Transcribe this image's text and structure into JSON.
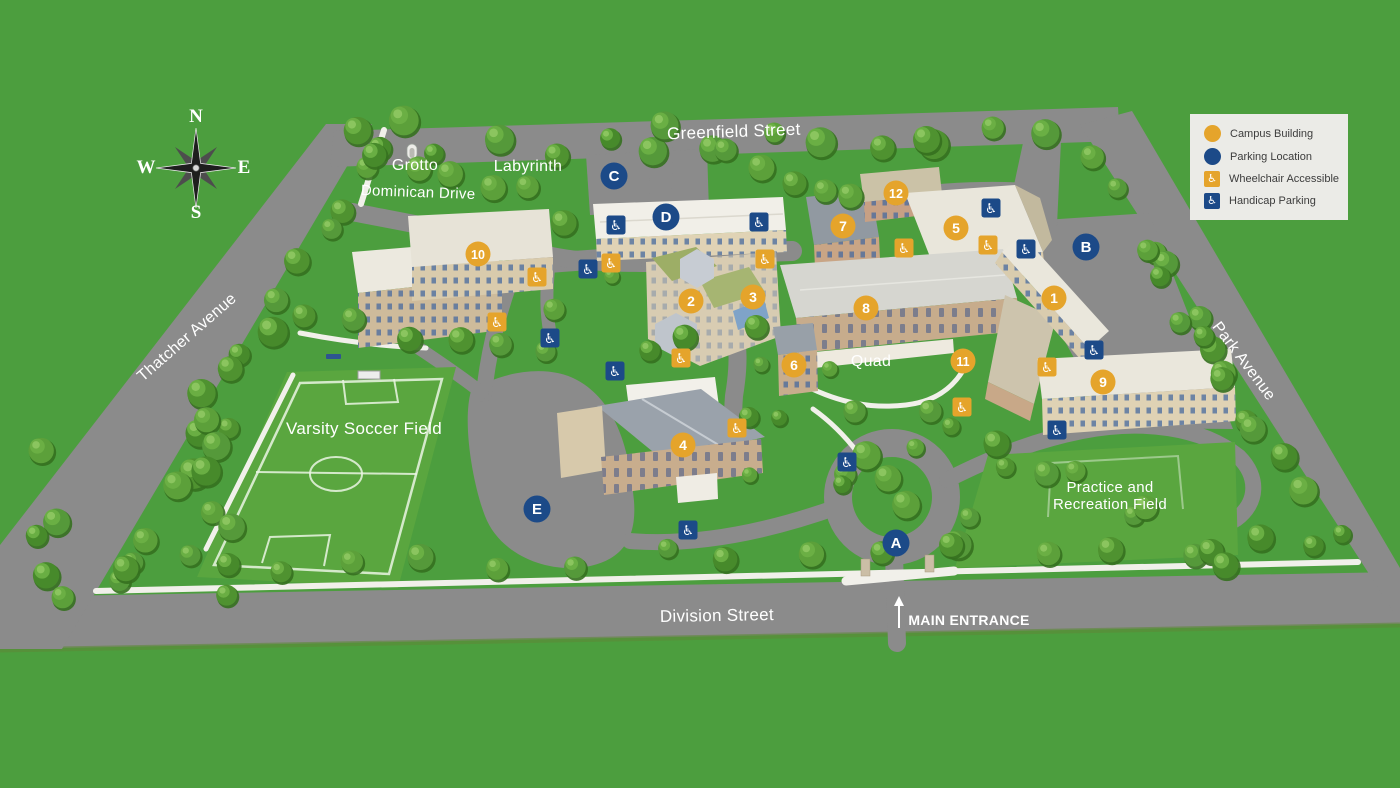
{
  "map": {
    "background_color": "#4C9E3E",
    "road_color": "#8B8B8B",
    "field_color": "#5AA63F",
    "walkway_color": "#F1F0EA",
    "legend_background": "#EBEBE7"
  },
  "colors": {
    "campus_building": "#E5A42B",
    "parking_location": "#1C4A88",
    "marker_text": "#FFFFFF"
  },
  "icons": {
    "wheelchair_glyph": "♿"
  },
  "compass": {
    "north": "N",
    "south": "S",
    "east": "E",
    "west": "W"
  },
  "legend": {
    "items": [
      {
        "id": "campus-building",
        "label": "Campus Building"
      },
      {
        "id": "parking-location",
        "label": "Parking Location"
      },
      {
        "id": "wheelchair-accessible",
        "label": "Wheelchair Accessible"
      },
      {
        "id": "handicap-parking",
        "label": "Handicap Parking"
      }
    ]
  },
  "streets": [
    {
      "name": "Greenfield Street",
      "x": 734,
      "y": 137,
      "rotation": -2,
      "size": 17
    },
    {
      "name": "Dominican Drive",
      "x": 418,
      "y": 197,
      "rotation": 2,
      "size": 15
    },
    {
      "name": "Thatcher Avenue",
      "x": 190,
      "y": 341,
      "rotation": -41,
      "size": 16
    },
    {
      "name": "Park Avenue",
      "x": 1240,
      "y": 364,
      "rotation": 53,
      "size": 16
    },
    {
      "name": "Division Street",
      "x": 717,
      "y": 621,
      "rotation": -1,
      "size": 17
    }
  ],
  "places": [
    {
      "name": "Grotto",
      "x": 415,
      "y": 170,
      "size": 16
    },
    {
      "name": "Labyrinth",
      "x": 528,
      "y": 171,
      "size": 16
    },
    {
      "name": "Quad",
      "x": 871,
      "y": 366,
      "size": 16
    },
    {
      "name": "Varsity Soccer Field",
      "x": 364,
      "y": 434,
      "size": 17
    },
    {
      "name": "Practice and Recreation Field",
      "x": 1110,
      "y": 492,
      "size": 15,
      "lines": [
        "Practice and",
        "Recreation Field"
      ]
    }
  ],
  "entrance": {
    "label": "MAIN ENTRANCE",
    "x": 969,
    "y": 625,
    "arrow_x": 899,
    "size": 14
  },
  "markers": {
    "buildings": [
      {
        "id": "1",
        "x": 1054,
        "y": 298
      },
      {
        "id": "2",
        "x": 691,
        "y": 301
      },
      {
        "id": "3",
        "x": 753,
        "y": 297
      },
      {
        "id": "4",
        "x": 683,
        "y": 445
      },
      {
        "id": "5",
        "x": 956,
        "y": 228
      },
      {
        "id": "6",
        "x": 794,
        "y": 365
      },
      {
        "id": "7",
        "x": 843,
        "y": 226
      },
      {
        "id": "8",
        "x": 866,
        "y": 308
      },
      {
        "id": "9",
        "x": 1103,
        "y": 382
      },
      {
        "id": "10",
        "x": 478,
        "y": 254
      },
      {
        "id": "11",
        "x": 963,
        "y": 361
      },
      {
        "id": "12",
        "x": 896,
        "y": 193
      }
    ],
    "parking": [
      {
        "id": "A",
        "x": 896,
        "y": 543
      },
      {
        "id": "B",
        "x": 1086,
        "y": 247
      },
      {
        "id": "C",
        "x": 614,
        "y": 176
      },
      {
        "id": "D",
        "x": 666,
        "y": 217
      },
      {
        "id": "E",
        "x": 537,
        "y": 509
      }
    ],
    "wheelchair_accessible": [
      {
        "x": 611,
        "y": 263
      },
      {
        "x": 765,
        "y": 259
      },
      {
        "x": 904,
        "y": 248
      },
      {
        "x": 988,
        "y": 245
      },
      {
        "x": 681,
        "y": 358
      },
      {
        "x": 537,
        "y": 277
      },
      {
        "x": 497,
        "y": 322
      },
      {
        "x": 737,
        "y": 428
      },
      {
        "x": 962,
        "y": 407
      },
      {
        "x": 1047,
        "y": 367
      }
    ],
    "handicap_parking": [
      {
        "x": 616,
        "y": 225
      },
      {
        "x": 759,
        "y": 222
      },
      {
        "x": 588,
        "y": 269
      },
      {
        "x": 991,
        "y": 208
      },
      {
        "x": 1026,
        "y": 249
      },
      {
        "x": 1094,
        "y": 350
      },
      {
        "x": 550,
        "y": 338
      },
      {
        "x": 615,
        "y": 371
      },
      {
        "x": 847,
        "y": 462
      },
      {
        "x": 688,
        "y": 530
      },
      {
        "x": 1057,
        "y": 430
      }
    ]
  }
}
